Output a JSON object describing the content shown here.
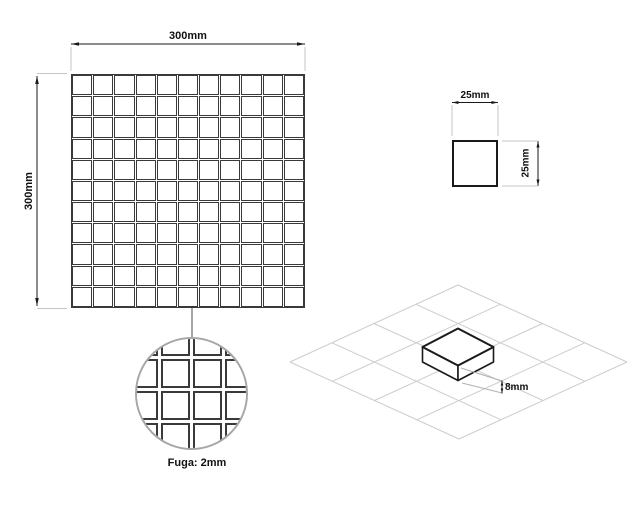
{
  "plan_view": {
    "width_label": "300mm",
    "height_label": "300mm",
    "grid": {
      "rows": 11,
      "cols": 11
    }
  },
  "tile_view": {
    "width_label": "25mm",
    "height_label": "25mm"
  },
  "detail_view": {
    "caption": "Fuga: 2mm",
    "grid": {
      "rows": 6,
      "cols": 6
    }
  },
  "iso_view": {
    "thickness_label": "8mm",
    "grid_rows": 4,
    "grid_cols": 4
  },
  "colors": {
    "tile_line": "#3a3a3a",
    "dimension_line": "#1a1a1a",
    "extension_line": "#c4c4c4",
    "leader_line": "#a6a6a6",
    "iso_grid_line": "#cccccc",
    "background": "#ffffff"
  }
}
